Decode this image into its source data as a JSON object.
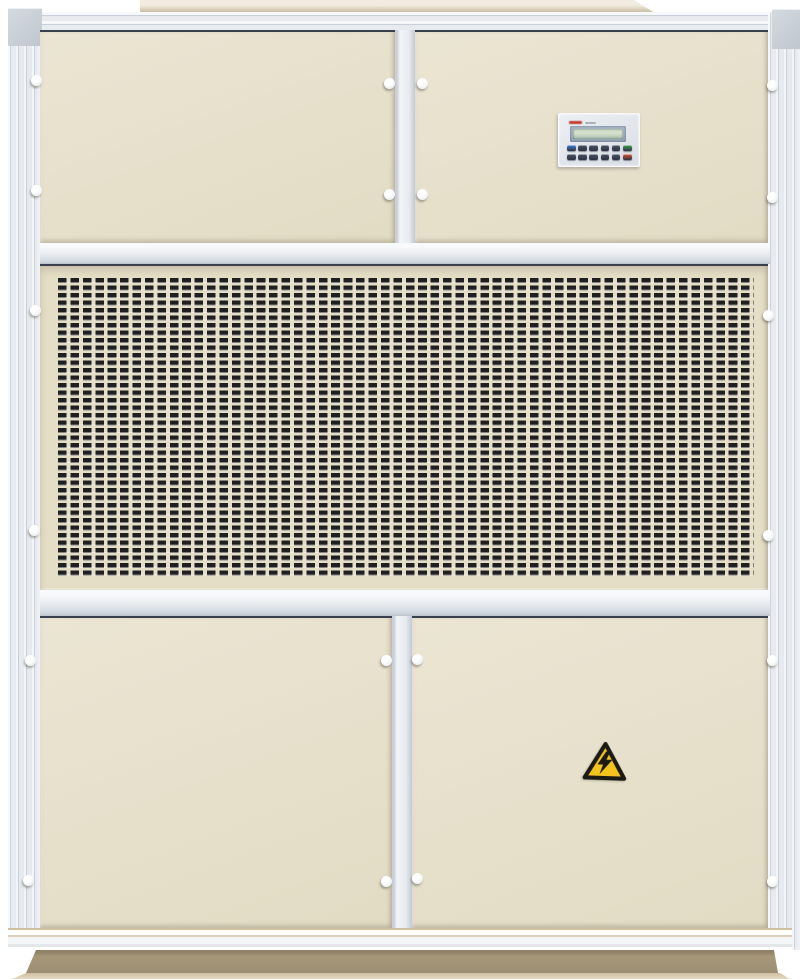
{
  "scene": {
    "type": "photograph",
    "subject": "industrial packaged air-handling / dehumidifier cabinet, front view",
    "visible_text": "none legible"
  },
  "colors": {
    "background": "#ffffff",
    "frame": "#e7ebf0",
    "frame_ridge": "#c8cfd8",
    "frame_highlight": "#f3f6f8",
    "corner_cap": "#c0c6cd",
    "panel_cream": "#ebe5d3",
    "panel_cream_dark": "#e2dbc4",
    "grille_cream": "#e5dec7",
    "slot_dark": "#1f1f22",
    "edge_dark": "#39404d",
    "knob": "#eef1f4",
    "duct": "#d5cdb6",
    "cp_body": "#d9dee6",
    "cp_brand": "#c23b2e",
    "cp_bezel": "#93a2b6",
    "cp_screen": "#a9bfae",
    "warn_yellow": "#f2c41d",
    "warn_black": "#1c1a15",
    "base": "#a69878",
    "base_light": "#cfbfa1"
  },
  "unit": {
    "sections": {
      "top_left": "access door",
      "top_right": "access door with controller",
      "middle": "perforated intake grille",
      "bottom_left": "access door",
      "bottom_right": "access door with electrical hazard sticker"
    },
    "grille": {
      "rows": 40,
      "columns": 56,
      "slot_shape": "rounded horizontal slot"
    },
    "knobs": [
      {
        "x": 36,
        "y": 80
      },
      {
        "x": 36,
        "y": 190
      },
      {
        "x": 389,
        "y": 83
      },
      {
        "x": 389,
        "y": 194
      },
      {
        "x": 422,
        "y": 83
      },
      {
        "x": 422,
        "y": 194
      },
      {
        "x": 772,
        "y": 85
      },
      {
        "x": 772,
        "y": 197
      },
      {
        "x": 35,
        "y": 310
      },
      {
        "x": 34,
        "y": 530
      },
      {
        "x": 768,
        "y": 315
      },
      {
        "x": 768,
        "y": 535
      },
      {
        "x": 30,
        "y": 660
      },
      {
        "x": 28,
        "y": 880
      },
      {
        "x": 386,
        "y": 660
      },
      {
        "x": 386,
        "y": 881
      },
      {
        "x": 417,
        "y": 659
      },
      {
        "x": 417,
        "y": 878
      },
      {
        "x": 772,
        "y": 660
      },
      {
        "x": 772,
        "y": 881
      }
    ]
  },
  "control_panel": {
    "display": "blank green LCD, no characters legible",
    "key_colors": [
      [
        "#3f7bd9",
        "#4a5164",
        "#4a5164",
        "#4a5164",
        "#4a5164",
        "#3fa453"
      ],
      [
        "#4a5164",
        "#4a5164",
        "#4a5164",
        "#4a5164",
        "#4a5164",
        "#e0552f"
      ]
    ]
  },
  "warning_sign": {
    "symbol": "lightning-bolt",
    "meaning": "electrical hazard",
    "shape": "yellow triangle with black border"
  }
}
